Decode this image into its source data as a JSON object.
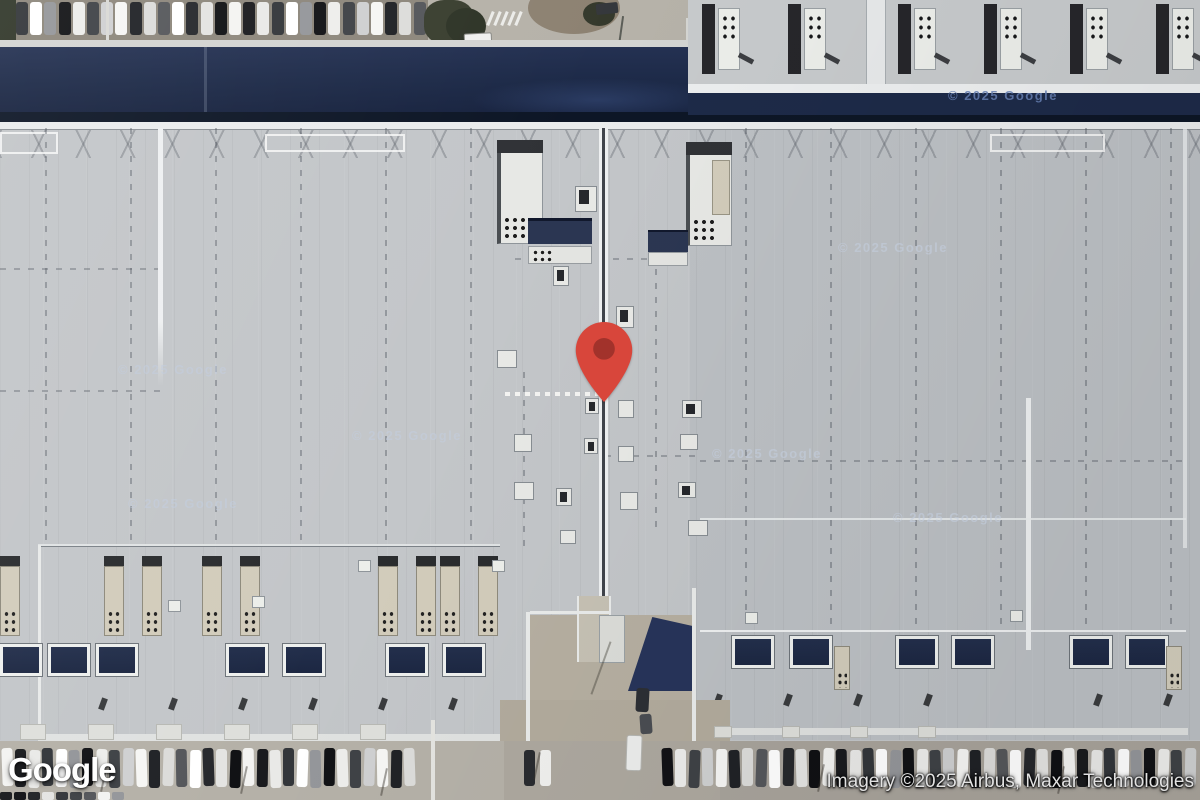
{
  "overlay": {
    "logo_text": "Google",
    "attribution_text": "Imagery ©2025 Airbus, Maxar Technologies",
    "watermark_text": "© 2025 Google",
    "watermarks": [
      {
        "x": 118,
        "y": 362,
        "variant": "roof"
      },
      {
        "x": 352,
        "y": 428,
        "variant": "roof"
      },
      {
        "x": 128,
        "y": 496,
        "variant": "roof"
      },
      {
        "x": 712,
        "y": 446,
        "variant": "roof"
      },
      {
        "x": 893,
        "y": 510,
        "variant": "roof"
      },
      {
        "x": 948,
        "y": 88,
        "variant": "navy"
      },
      {
        "x": 838,
        "y": 240,
        "variant": "roof"
      }
    ]
  },
  "marker": {
    "name": "location-pin",
    "color": "#D8463B",
    "inner_color": "#A2322B"
  },
  "colors": {
    "roof_gray": "#c3c6c9",
    "navy_roof": "#1d2a48",
    "navy_edge": "#0d1626",
    "skylight_navy": "#1c2742",
    "pavement": "#aaa59b",
    "vent_tan": "#d2ccbb",
    "parking_brown": "#8d877c",
    "white_seam": "#eef0f1"
  }
}
